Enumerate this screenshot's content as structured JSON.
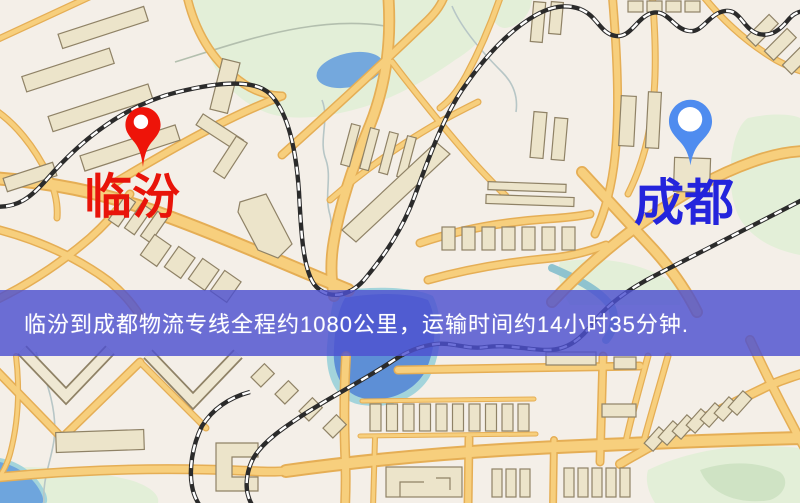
{
  "banner": {
    "text": "临汾到成都物流专线全程约1080公里，运输时间约14小时35分钟."
  },
  "route": {
    "origin": "临汾",
    "destination": "成都",
    "distance_text": "约1080公里",
    "duration_text": "约14小时35分钟"
  },
  "markers": {
    "origin": {
      "label": "临汾",
      "label_color": "#e8140a",
      "pin_color": "#ee1409"
    },
    "destination": {
      "label": "成都",
      "label_color": "#2424dc",
      "pin_color": "#4f8cef"
    }
  },
  "map_colors": {
    "background": "#f4efe8",
    "park": "#e3efd8",
    "water": "#5d8fd6",
    "water_shore": "#a3d4db",
    "pond": "#74a8dd",
    "road_fill": "#f7cf7d",
    "road_casing": "#e5ae55",
    "building_fill": "#ece4ca",
    "building_stroke": "#8f8266",
    "railway": "#2b2b2b",
    "banner_overlay": "#4d50cf"
  }
}
